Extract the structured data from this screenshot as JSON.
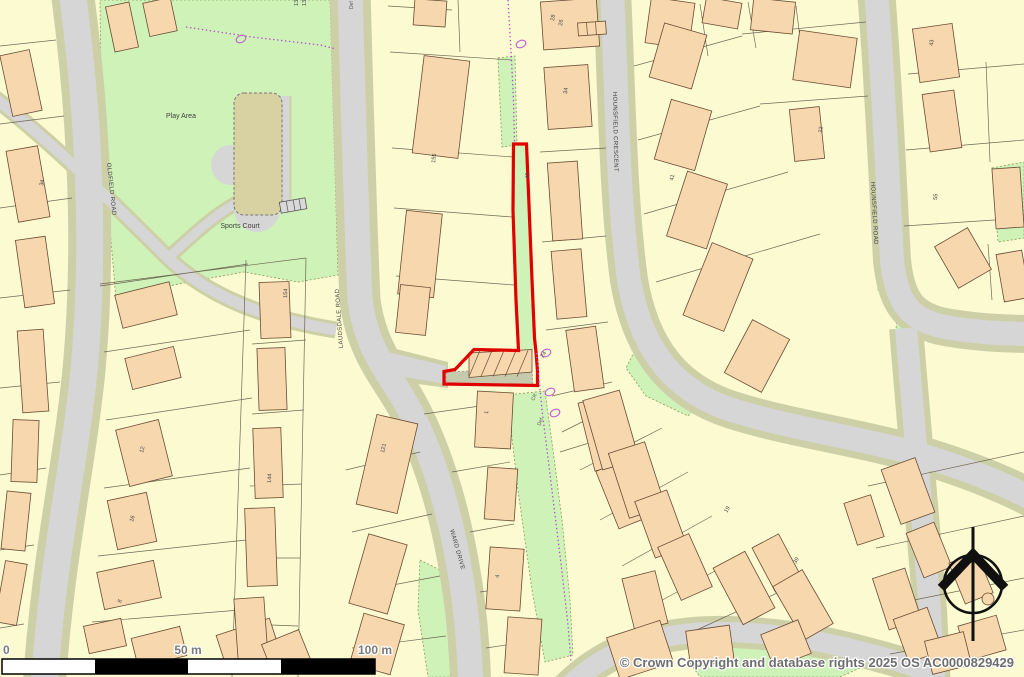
{
  "map_type": "ordnance-survey-style-site-plan",
  "colors": {
    "background": "#FBFAD0",
    "green_space": "#CFF2B8",
    "road_fill": "#D6D6D6",
    "road_verge": "#CDD0A6",
    "building_fill": "#F6D7AE",
    "building_outline": "#6B4C33",
    "parcel_line": "#5A5040",
    "sports_court_fill": "#D8D2A2",
    "site_boundary_red": "#E10000",
    "boundary_purple": "#B050C8",
    "tree_purple": "#C35FD4",
    "scalebar_black": "#000000",
    "label_gray": "#6E6E6E"
  },
  "roads": {
    "oldfield": "OLDFIELD ROAD",
    "laudsdale": "LAUDSDALE ROAD",
    "ward_drive": "WARD DRIVE",
    "hounsfield_crescent": "HOUNSFIELD CRESCENT",
    "hounsfield_road": "HOUNSFIELD ROAD"
  },
  "areas": {
    "play_area": "Play Area",
    "sports_court": "Sports Court"
  },
  "house_numbers": [
    "155",
    "42",
    "28",
    "26",
    "34",
    "34",
    "1",
    "24",
    "12",
    "154",
    "144",
    "121",
    "55",
    "43",
    "22",
    "41",
    "4",
    "19",
    "39",
    "8",
    "16",
    "130",
    "134"
  ],
  "annotations": {
    "def_top": "Def",
    "cr": "CR",
    "def_mid": "Def"
  },
  "scale_bar": {
    "zero": "0",
    "fifty": "50 m",
    "hundred": "100 m"
  },
  "attribution": "© Crown Copyright and database rights 2025 OS AC0000829429"
}
